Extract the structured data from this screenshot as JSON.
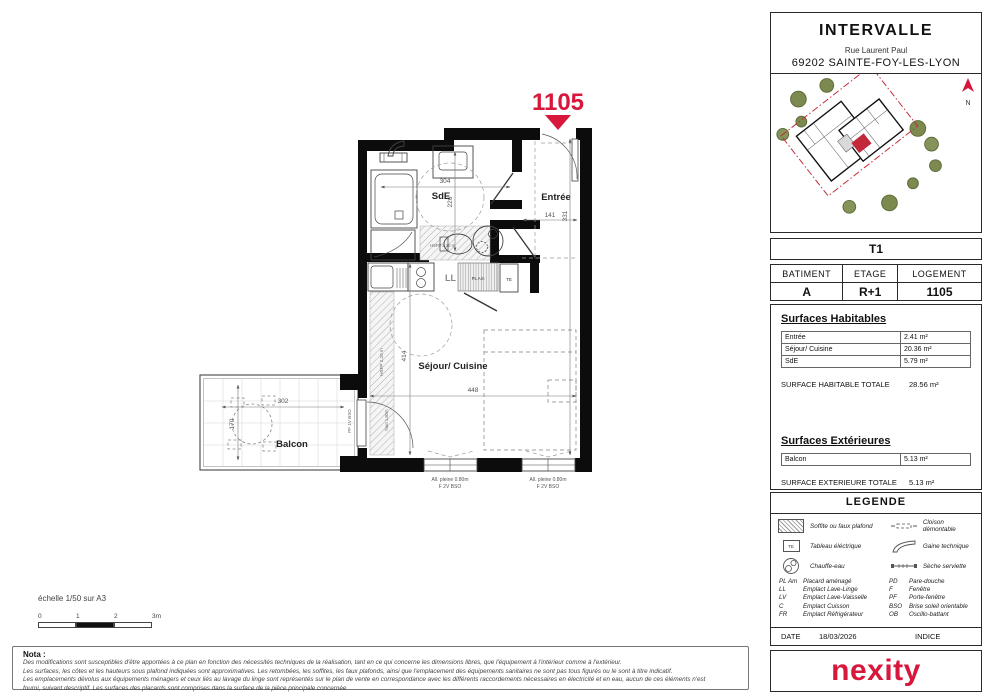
{
  "colors": {
    "accent": "#d8173c",
    "wall": "#0c0c0c",
    "tree": "#7c8a50"
  },
  "header": {
    "title": "INTERVALLE",
    "address1": "Rue Laurent Paul",
    "address2": "69202 SAINTE-FOY-LES-LYON"
  },
  "north_label": "N",
  "unit": {
    "tag": "1105",
    "type": "T1",
    "table": {
      "headers": [
        "BATIMENT",
        "ETAGE",
        "LOGEMENT"
      ],
      "values": [
        "A",
        "R+1",
        "1105"
      ]
    }
  },
  "surfaces_habitables": {
    "title": "Surfaces Habitables",
    "rows": [
      {
        "label": "Entrée",
        "value": "2.41 m²"
      },
      {
        "label": "Séjour/ Cuisine",
        "value": "20.36 m²"
      },
      {
        "label": "SdE",
        "value": "5.79 m²"
      }
    ],
    "total_label": "SURFACE HABITABLE TOTALE",
    "total_value": "28.56 m²"
  },
  "surfaces_exterieures": {
    "title": "Surfaces Extérieures",
    "rows": [
      {
        "label": "Balcon",
        "value": "5.13 m²"
      }
    ],
    "total_label": "SURFACE EXTERIEURE TOTALE",
    "total_value": "5.13 m²"
  },
  "legende": {
    "title": "LEGENDE",
    "items": [
      {
        "icon": "soffit-hatch",
        "label": "Soffite ou faux plafond"
      },
      {
        "icon": "removable-partition",
        "label": "Cloison démontable"
      },
      {
        "icon": "electrical-panel",
        "label": "Tableau éléctrique"
      },
      {
        "icon": "technical-duct",
        "label": "Gaine technique"
      },
      {
        "icon": "water-heater",
        "label": "Chauffe-eau"
      },
      {
        "icon": "towel-dryer",
        "label": "Sèche serviette"
      }
    ]
  },
  "abbreviations": {
    "rows": [
      {
        "c1": "PL Am",
        "l1": "Placard aménagé",
        "c2": "PD",
        "l2": "Pare-douche"
      },
      {
        "c1": "LL",
        "l1": "Emplact Lave-Linge",
        "c2": "F",
        "l2": "Fenêtre"
      },
      {
        "c1": "LV",
        "l1": "Emplact Lave-Vaisselle",
        "c2": "PF",
        "l2": "Porte-fenêtre"
      },
      {
        "c1": "C",
        "l1": "Emplact Cuisson",
        "c2": "BSO",
        "l2": "Brise soleil orientable"
      },
      {
        "c1": "FR",
        "l1": "Emplact Réfrigérateur",
        "c2": "OB",
        "l2": "Oscillo-battant"
      }
    ]
  },
  "footer": {
    "date_label": "DATE",
    "date": "18/03/2026",
    "indice_label": "INDICE",
    "logo": "nexity"
  },
  "scalebar": {
    "label": "échelle 1/50 sur A3",
    "ticks": [
      "0",
      "1",
      "2",
      "3m"
    ]
  },
  "nota": {
    "title": "Nota :",
    "lines": [
      "Des modifications sont susceptibles d'être apportées à ce plan en fonction des nécessités techniques de la réalisation, tant en ce qui concerne les dimensions libres, que l'équipement à l'intérieur comme à l'extérieur.",
      "Les surfaces, les côtes et les hauteurs sous plafond indiquées sont approximatives. Les retombées, les soffites, les faux plafonds, ainsi que l'emplacement des équipements sanitaires ne sont pas tous figurés ou le sont à titre indicatif.",
      "Les emplacements dévolus aux équipements ménagers et ceux liés au lavage du linge sont représentés sur le plan de vente en correspondance avec les différents raccordements nécessaires en électricité et en eau, aucun de ces éléments n'est",
      "fourni, suivant descriptif. Les surfaces des placards sont comprises dans la surface de la pièce principale concernée"
    ]
  },
  "plan": {
    "rooms": {
      "sde": "SdE",
      "entree": "Entrée",
      "sejour": "Séjour/ Cuisine",
      "balcon": "Balcon"
    },
    "dims": {
      "sde_w": "304",
      "sde_h": "226",
      "entree_w": "141",
      "entree_h": "331",
      "sejour_h": "414",
      "sejour_w": "448",
      "balcon_w": "302",
      "balcon_h": "170"
    },
    "labels": {
      "ll": "LL",
      "te": "TE",
      "pl_am": "PL Am",
      "hsfp": "HSFP 2.20 m",
      "pf_door": "PF 1V BSO",
      "door_h": "haut 1.80m",
      "allege": "All. pleine 0.80m",
      "window": "F 2V BSO"
    }
  }
}
